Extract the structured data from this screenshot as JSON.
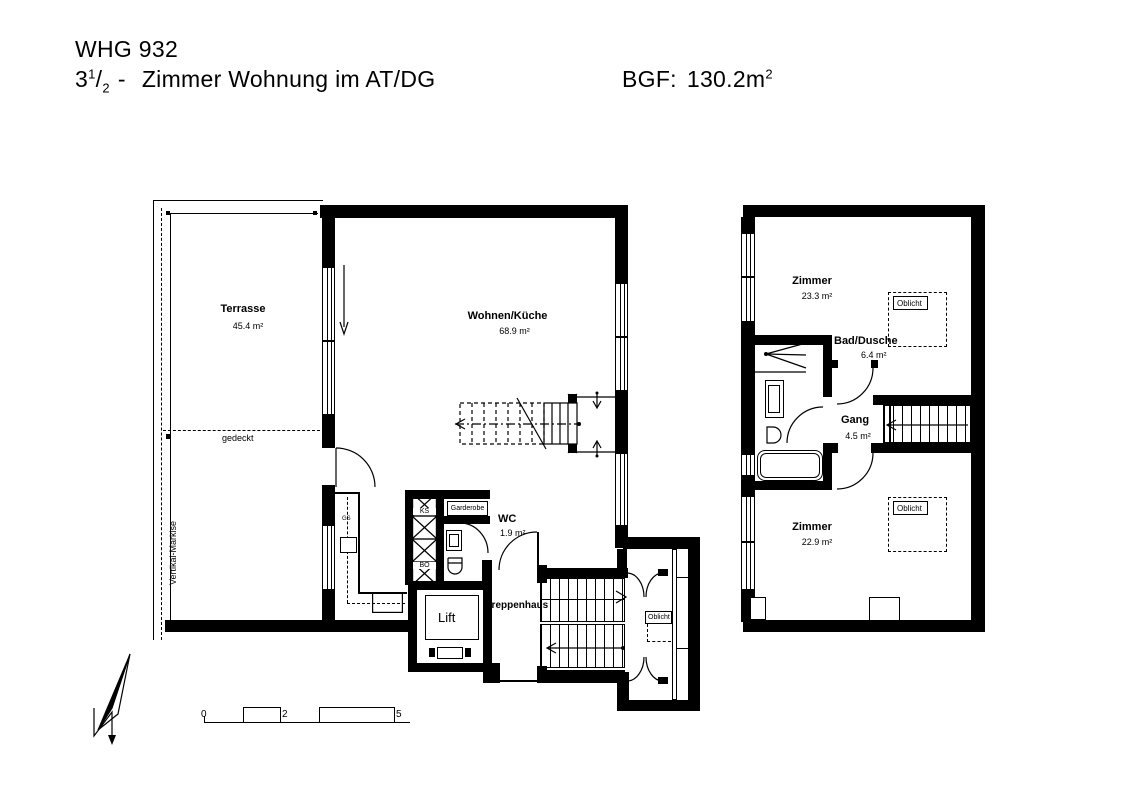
{
  "title": {
    "line1": "WHG 932",
    "line2_num": "3",
    "frac_num": "1",
    "frac_slash": "/",
    "frac_den": "2",
    "line2_dash": "-",
    "line2_rest": "Zimmer Wohnung im AT/DG",
    "bgf_label": "BGF:",
    "bgf_value": "130.2m",
    "bgf_sup": "2"
  },
  "floor_main": {
    "terrasse_name": "Terrasse",
    "terrasse_area": "45.4 m²",
    "gedeckt": "gedeckt",
    "markise": "Vertikal-Markise",
    "wohnen_name": "Wohnen/Küche",
    "wohnen_area": "68.9 m²",
    "wc_name": "WC",
    "wc_area": "1.9 m²",
    "garderobe": "Garderobe",
    "ks": "KS",
    "bo": "BO",
    "gs": "GS",
    "lift": "Lift",
    "treppenhaus": "Treppenhaus",
    "oblicht": "Oblicht"
  },
  "floor_upper": {
    "zimmer_top_name": "Zimmer",
    "zimmer_top_area": "23.3 m²",
    "bad_name": "Bad/Dusche",
    "bad_area": "6.4 m²",
    "gang_name": "Gang",
    "gang_area": "4.5 m²",
    "zimmer_bottom_name": "Zimmer",
    "zimmer_bottom_area": "22.9 m²",
    "oblicht_top": "Oblicht",
    "oblicht_bottom": "Oblicht"
  },
  "scale_bar": {
    "labels": [
      "0",
      "1",
      "2",
      "3",
      "5"
    ]
  },
  "colors": {
    "line": "#000000",
    "background": "#ffffff"
  }
}
